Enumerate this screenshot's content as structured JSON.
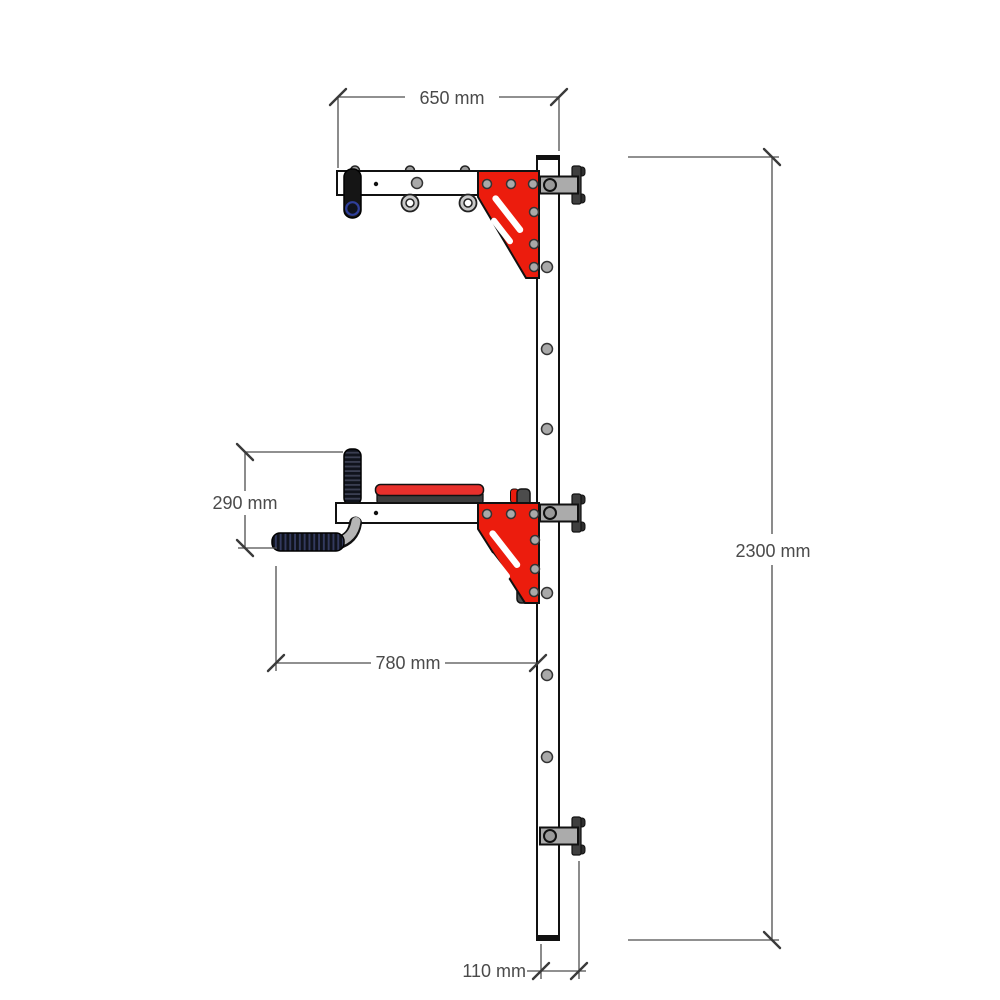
{
  "drawing": {
    "type": "technical-drawing",
    "subject": "wall-mounted pull-up and dip station, side elevation",
    "dimensions": [
      {
        "id": "top_arm_width",
        "label": "650 mm"
      },
      {
        "id": "overall_height",
        "label": "2300 mm"
      },
      {
        "id": "handle_drop",
        "label": "290 mm"
      },
      {
        "id": "dip_reach",
        "label": "780 mm"
      },
      {
        "id": "wall_offset",
        "label": "110 mm"
      }
    ]
  },
  "colors": {
    "gusset_red": "#ec1c0d",
    "pad_red": "#e8302c",
    "bracket_gray": "#ababab",
    "flange_gray": "#3f3f3f",
    "plate_gray": "#4c4c4c",
    "tube_gray": "#b5b5b5",
    "grip_black": "#151515",
    "grip_blue": "#2f3f9a",
    "outline": "#111111",
    "dim_gray": "#4a4a4a",
    "background": "#ffffff"
  }
}
